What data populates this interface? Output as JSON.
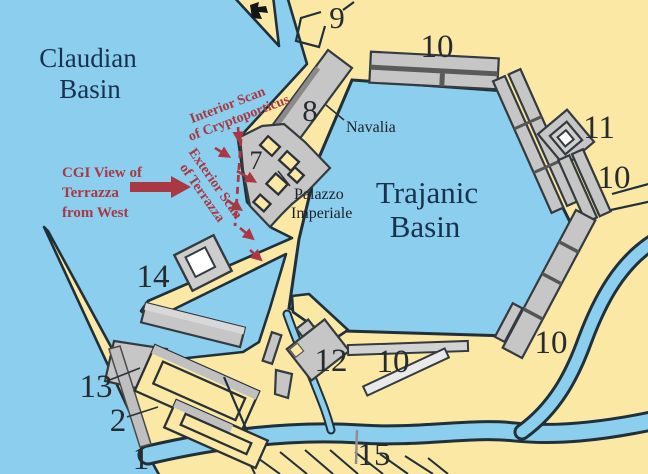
{
  "map": {
    "basins": {
      "claudian": {
        "line1": "Claudian",
        "line2": "Basin"
      },
      "trajanic": {
        "line1": "Trajanic",
        "line2": "Basin"
      }
    },
    "structures": {
      "n1": "1",
      "n2": "2",
      "n7": "7",
      "n8": "8",
      "n9": "9",
      "n10_top": "10",
      "n10_ne": "10",
      "n10_se": "10",
      "n10_south": "10",
      "n11": "11",
      "n12": "12",
      "n13": "13",
      "n14": "14",
      "n15": "15",
      "navalia": "Navalia",
      "palazzo": {
        "line1": "Palazzo",
        "line2": "Imperiale"
      }
    },
    "annotations": {
      "interior_scan": {
        "line1": "Interior Scan",
        "line2": "of Cryptoporticus"
      },
      "exterior_scan": {
        "line1": "Exterior Scan",
        "line2": "of Terrazza"
      },
      "cgi_view": {
        "line1": "CGI View of",
        "line2": "Terrazza",
        "line3": "from West"
      }
    },
    "colors": {
      "water": "#8cceee",
      "land": "#fbe8a5",
      "building_gray": "#c6c6c6",
      "coast_outline": "#20303a",
      "annotation_red": "#a93843",
      "basin_label_blue": "#17324e",
      "number_label": "#262b2e"
    }
  }
}
